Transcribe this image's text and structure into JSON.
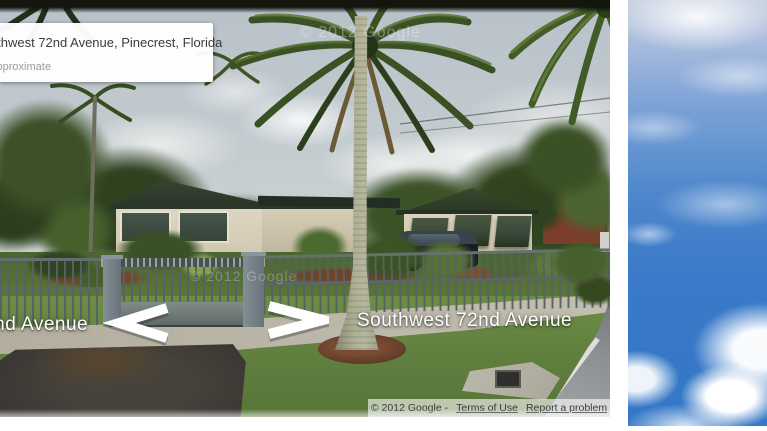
{
  "street_view": {
    "address_bubble": {
      "title": "Southwest 72nd Avenue, Pinecrest, Florida",
      "subtitle": "Address is approximate"
    },
    "street_labels": {
      "left_label": "Southwest 72nd Avenue",
      "right_label": "Southwest 72nd Avenue"
    },
    "navigation_arrows": {
      "left": "chevron-left-arrow",
      "right": "chevron-right-arrow"
    },
    "attribution": {
      "copyright_text": "© 2012 Google -",
      "terms_of_use_label": "Terms of Use",
      "report_a_problem_label": "Report a problem"
    },
    "watermark_text": "© 2012 Google",
    "colors": {
      "sky_photo": "#c7ced2",
      "lawn_green": "#5a7739",
      "roof_green": "#2f3d2a",
      "wall_cream": "#d9d2bd",
      "fence_gray": "#5e6a6b",
      "mulch_brown": "#74462f",
      "asphalt_gray": "#413e39",
      "label_white": "#ffffff"
    }
  },
  "side_image": {
    "colors": {
      "sky_top": "#a9bcdd",
      "sky_bottom": "#3377c6",
      "cloud_white": "#ffffff"
    }
  }
}
